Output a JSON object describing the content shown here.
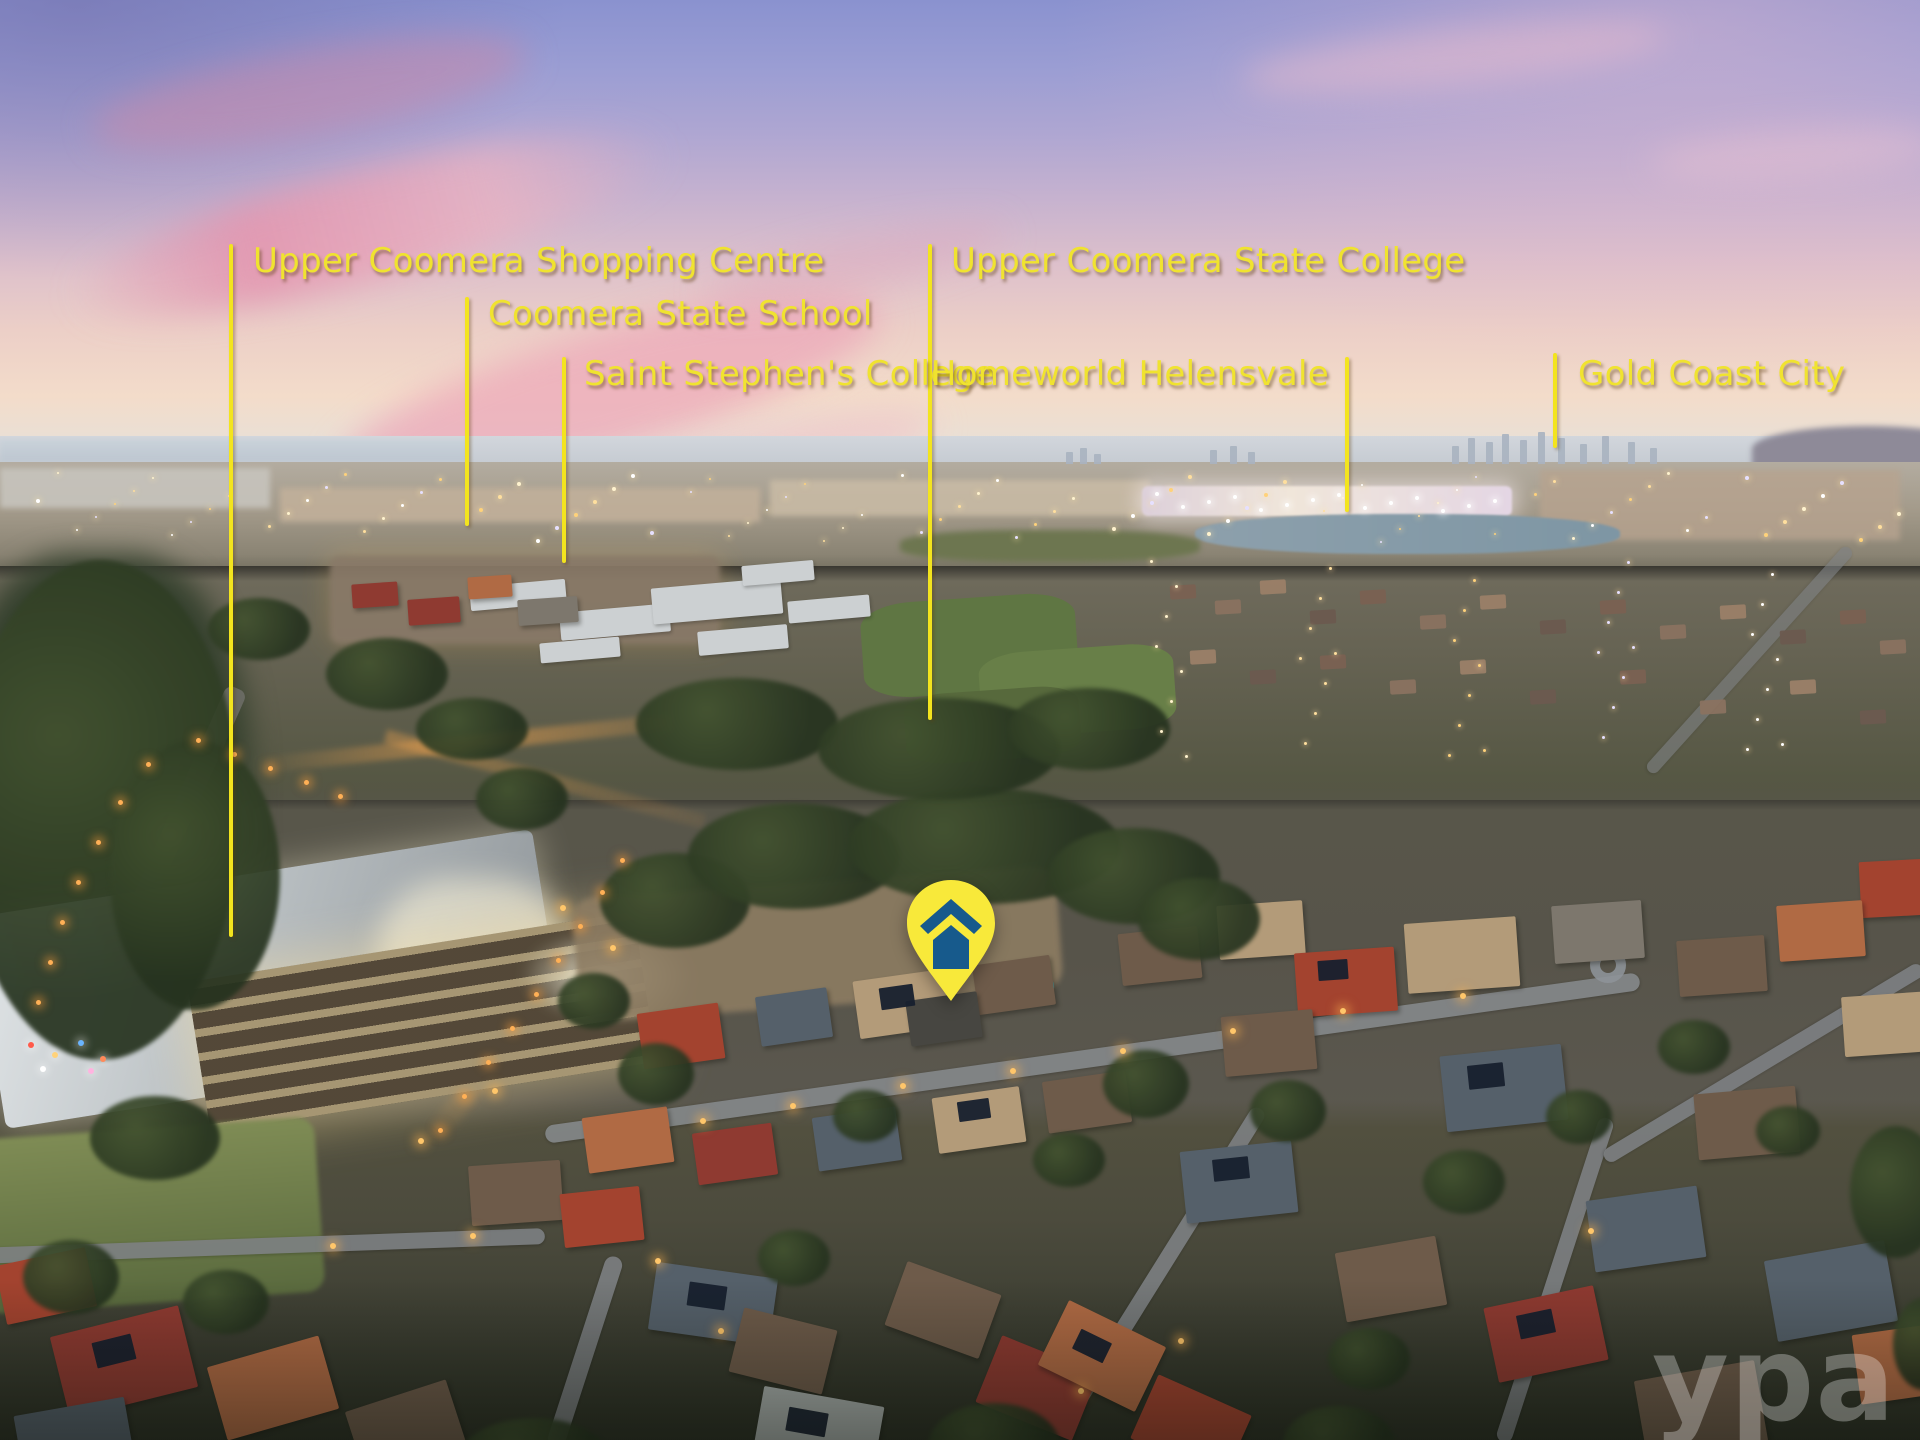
{
  "scene": {
    "description": "Aerial dusk photograph of a residential suburb with landmark annotations",
    "watermark": {
      "text": "ypa"
    }
  },
  "annotations": {
    "label_color": "#f0e32f",
    "line_color": "#f3e41e",
    "labels": [
      {
        "id": "upper-coomera-shopping-centre",
        "text": "Upper Coomera Shopping Centre"
      },
      {
        "id": "coomera-state-school",
        "text": "Coomera State School"
      },
      {
        "id": "saint-stephens-college",
        "text": "Saint Stephen's College"
      },
      {
        "id": "upper-coomera-state-college",
        "text": "Upper Coomera State College"
      },
      {
        "id": "homeworld-helensvale",
        "text": "Homeworld Helensvale"
      },
      {
        "id": "gold-coast-city",
        "text": "Gold Coast City"
      }
    ]
  },
  "marker": {
    "name": "property-location-pin",
    "shape": "map-pin",
    "fill": "#f8e93a",
    "icon": "house-icon",
    "icon_color": "#175a8c"
  }
}
